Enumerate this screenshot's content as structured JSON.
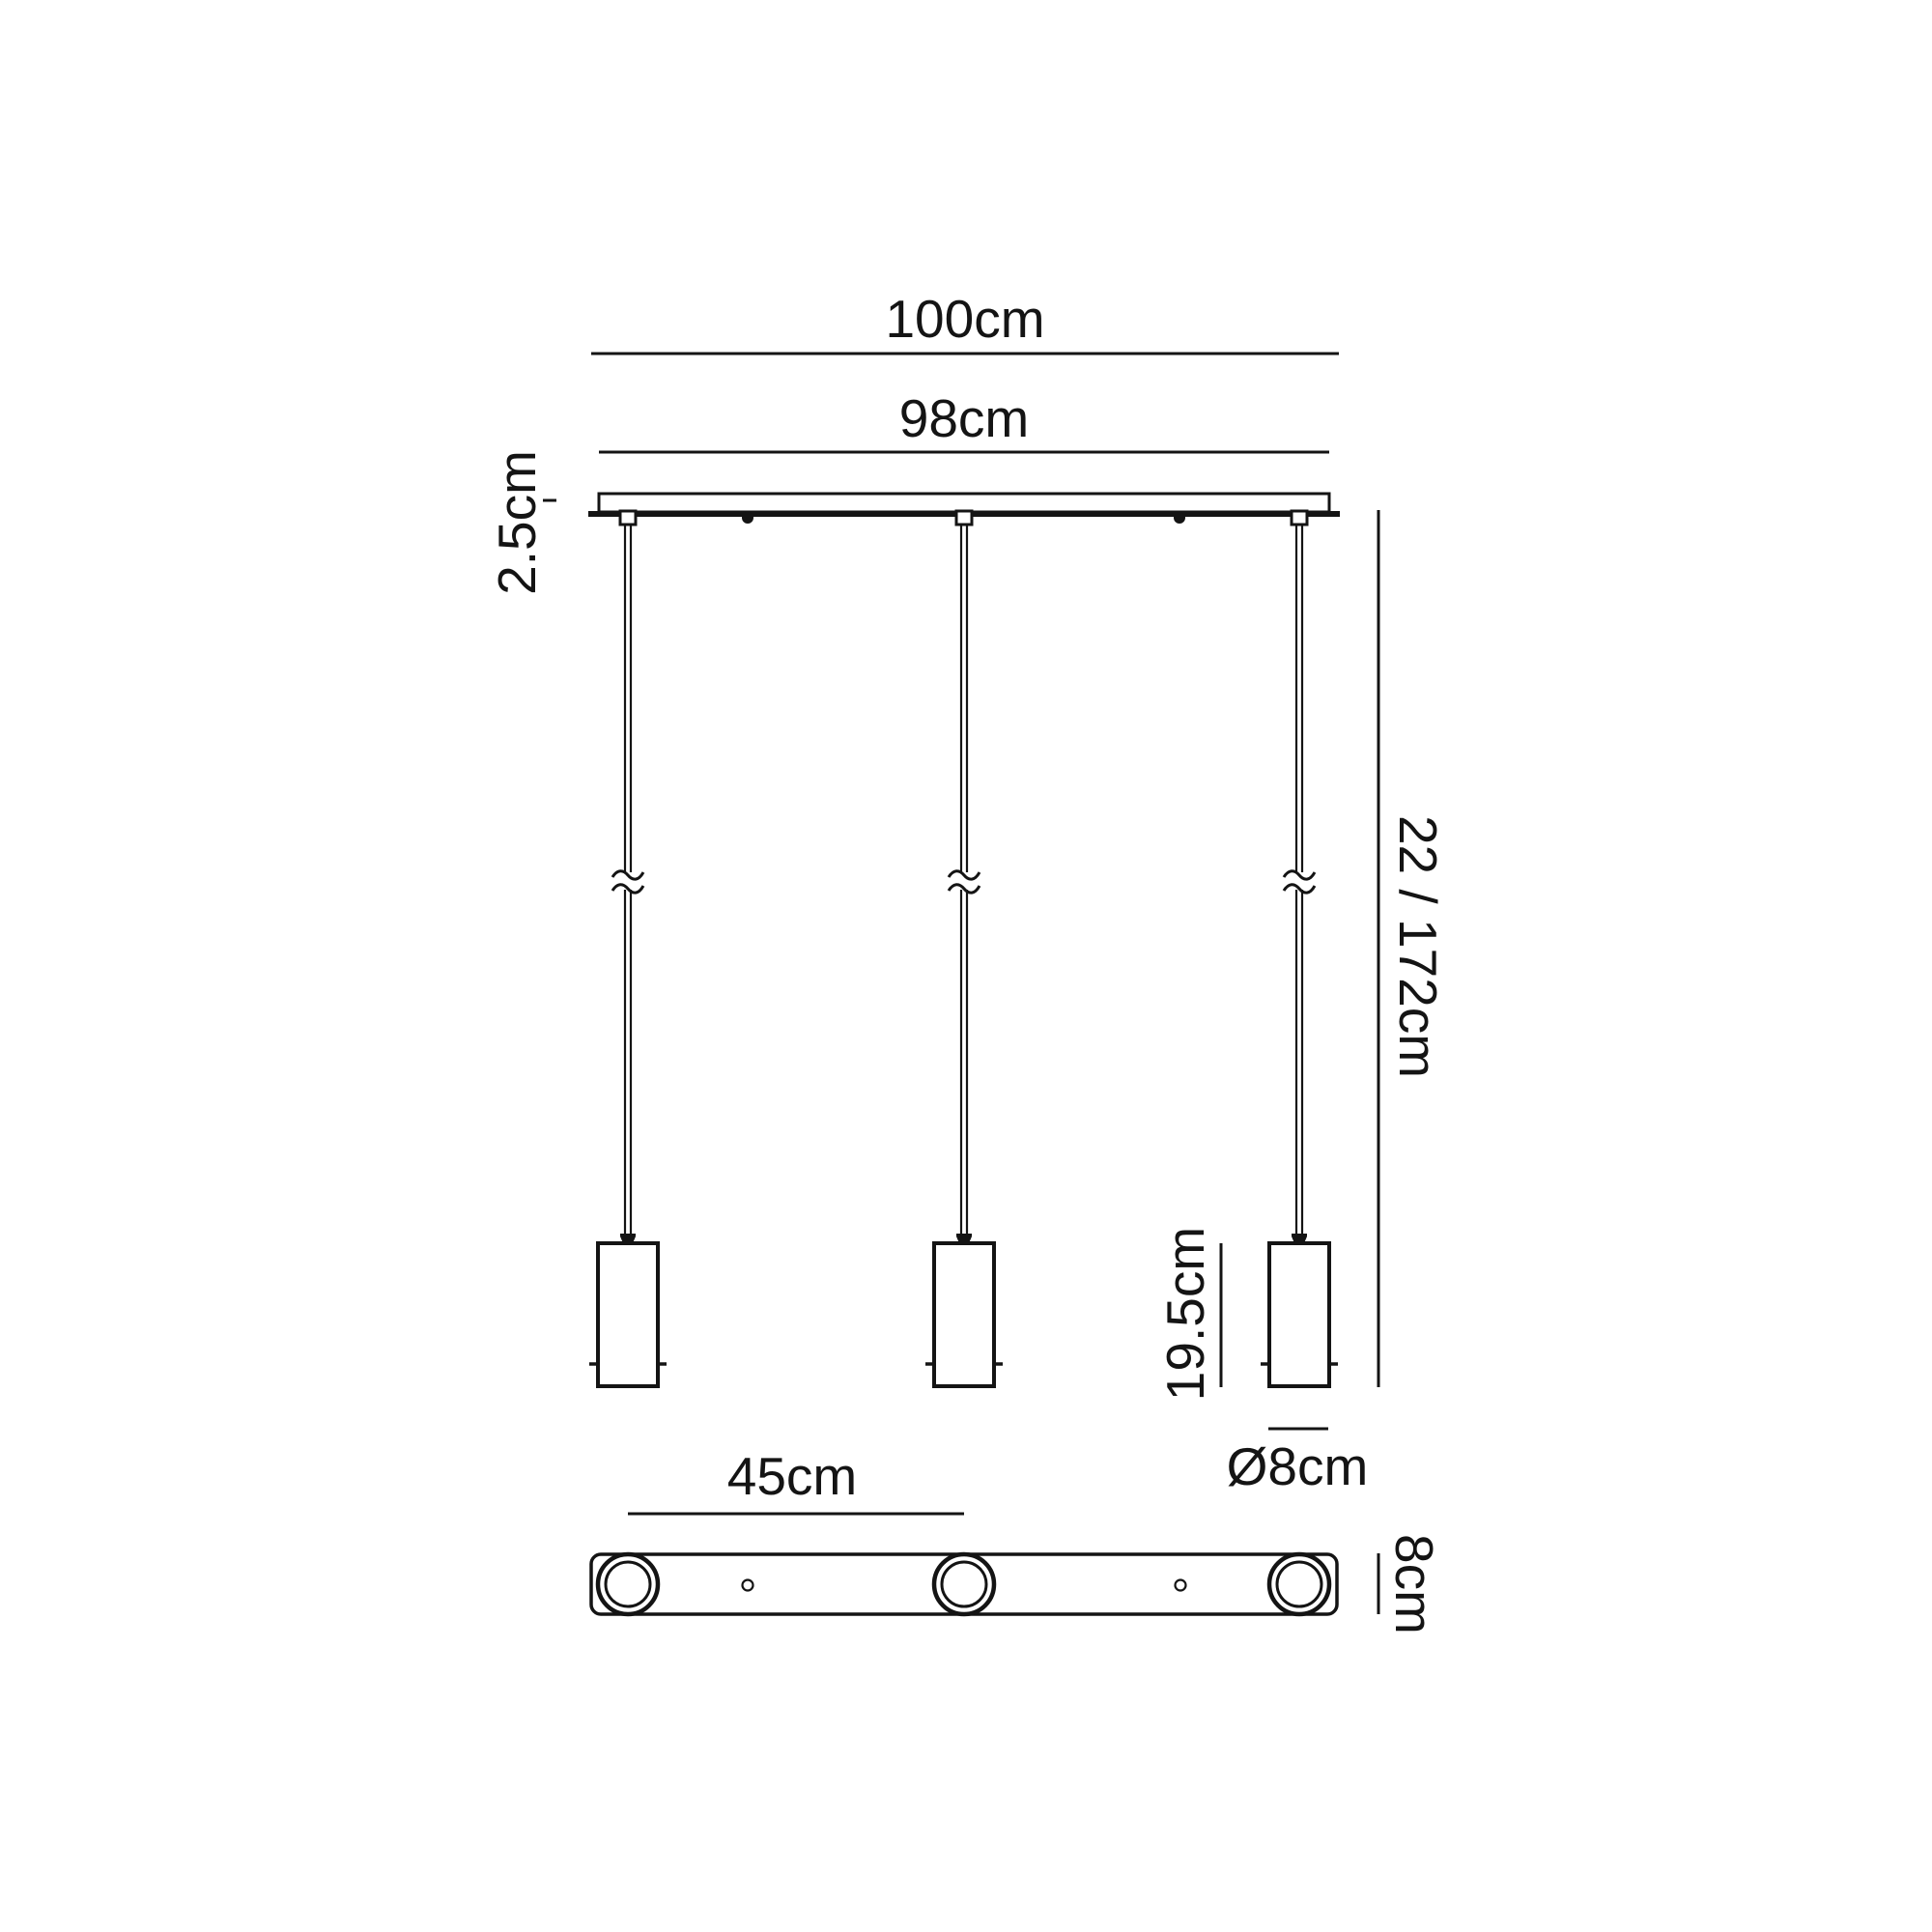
{
  "figure": {
    "kind": "pendant-luminaire-dimension-drawing",
    "background": "#ffffff",
    "line_color": "#141414",
    "pendant_count": 3,
    "labels": {
      "overall_width": "100cm",
      "canopy_width": "98cm",
      "canopy_height": "2.5cm",
      "drop_range": "22 / 172cm",
      "shade_height": "19.5cm",
      "shade_diameter": "Ø8cm",
      "shade_spacing": "45cm",
      "canopy_depth": "8cm"
    }
  }
}
